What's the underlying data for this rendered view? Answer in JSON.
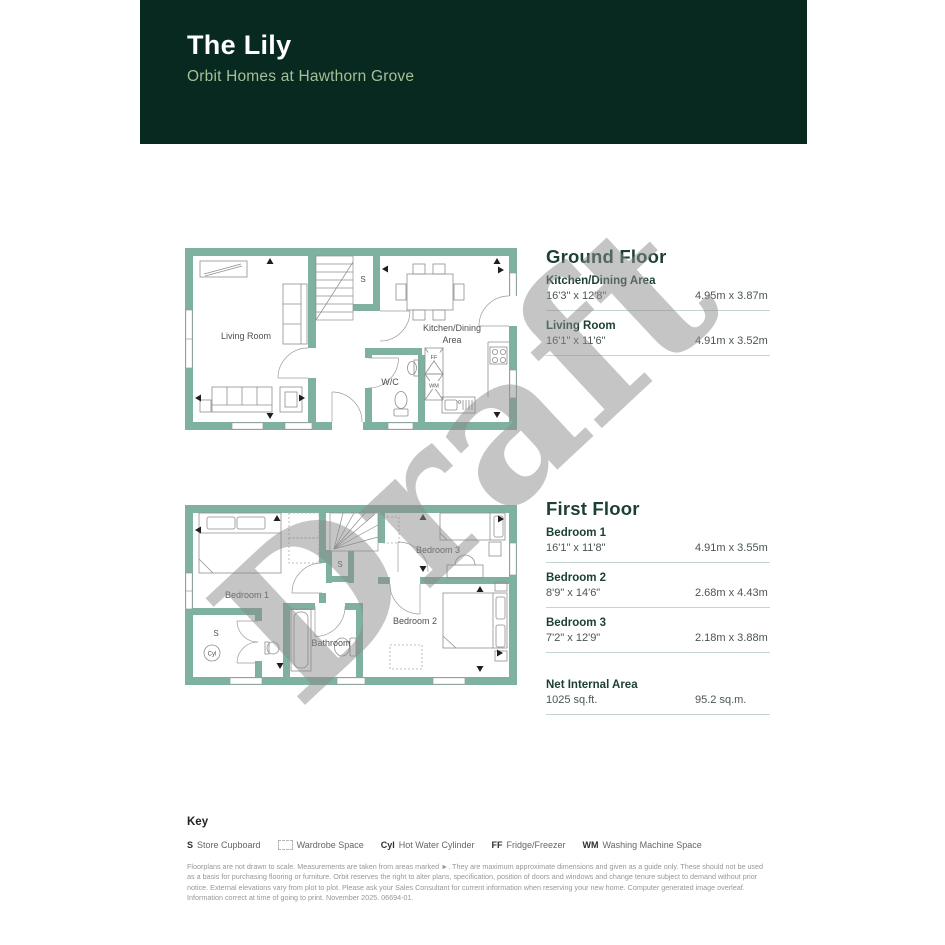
{
  "header": {
    "title": "The Lily",
    "subtitle": "Orbit Homes at Hawthorn Grove"
  },
  "watermark": "Draft",
  "ground_floor": {
    "heading": "Ground Floor",
    "rooms": [
      {
        "name": "Kitchen/Dining Area",
        "imperial": "16'3\" x 12'8\"",
        "metric": "4.95m x 3.87m"
      },
      {
        "name": "Living Room",
        "imperial": "16'1\" x 11'6\"",
        "metric": "4.91m x 3.52m"
      }
    ],
    "plan_labels": {
      "living_room": "Living Room",
      "kitchen_line1": "Kitchen/Dining",
      "kitchen_line2": "Area",
      "wc": "W/C",
      "store": "S",
      "ff": "FF",
      "wm": "WM"
    }
  },
  "first_floor": {
    "heading": "First Floor",
    "rooms": [
      {
        "name": "Bedroom 1",
        "imperial": "16'1\" x 11'8\"",
        "metric": "4.91m x 3.55m"
      },
      {
        "name": "Bedroom 2",
        "imperial": "8'9\" x 14'6\"",
        "metric": "2.68m x 4.43m"
      },
      {
        "name": "Bedroom 3",
        "imperial": "7'2\" x 12'9\"",
        "metric": "2.18m x 3.88m"
      }
    ],
    "net_internal_area": {
      "label": "Net Internal Area",
      "imperial": "1025 sq.ft.",
      "metric": "95.2 sq.m."
    },
    "plan_labels": {
      "bedroom1": "Bedroom 1",
      "bedroom2": "Bedroom 2",
      "bedroom3": "Bedroom 3",
      "bathroom": "Bathroom",
      "store": "S",
      "cupboard": "S",
      "cyl": "Cyl"
    }
  },
  "key": {
    "heading": "Key",
    "items": [
      {
        "prefix": "S",
        "label": "Store Cupboard"
      },
      {
        "prefix": "",
        "label": "Wardrobe Space"
      },
      {
        "prefix": "Cyl",
        "label": "Hot Water Cylinder"
      },
      {
        "prefix": "FF",
        "label": "Fridge/Freezer"
      },
      {
        "prefix": "WM",
        "label": "Washing Machine Space"
      }
    ]
  },
  "disclaimer": "Floorplans are not drawn to scale. Measurements are taken from areas marked ►. They are maximum approximate dimensions and given as a guide only. These should not be used as a basis for purchasing flooring or furniture. Orbit reserves the right to alter plans, specification, position of doors and windows and change tenure subject to demand without prior notice. External elevations vary from plot to plot. Please ask your Sales Consultant for current information when reserving your new home. Computer generated image overleaf. Information correct at time of going to print. November 2025. 06694-01.",
  "colors": {
    "header_bg": "#07291f",
    "wall_green": "#7fb1a0",
    "heading_green": "#1d4035",
    "subtitle_green": "#a5bf97",
    "watermark_gray": "#8c8c8c"
  }
}
